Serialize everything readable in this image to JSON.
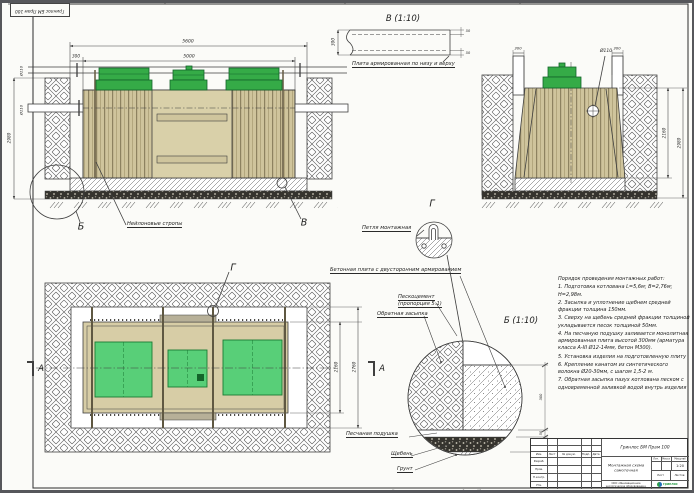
{
  "sheet": {
    "corner_stamp": "Гринлос БМ Прам 100",
    "footer_copied": "Копировал",
    "footer_format": "Формат A3"
  },
  "front_view": {
    "dim_overall": "5600",
    "dim_tank": "5000",
    "dim_offset": "300",
    "dim_depth": "2980",
    "dim_pipe_upper": "Ø110",
    "dim_pipe_lower": "Ø110",
    "label_slings": "Нейлоновые стропы",
    "callout_b": "Б",
    "callout_v": "В"
  },
  "detail_v": {
    "title": "В (1:10)",
    "label_plate": "Плита армированная по низу и верху",
    "dim_thickness": "300",
    "dim_cover_top": "50",
    "dim_cover_bottom": "50"
  },
  "side_view": {
    "dim_gap_left": "300",
    "dim_gap_right": "300",
    "dim_pipe": "Ø110",
    "dim_tank_height": "2160",
    "dim_pit_depth": "2980"
  },
  "detail_g": {
    "title": "Г",
    "label_loop": "Петля монтажная"
  },
  "plan_view": {
    "label_plate": "Бетонная плита с двусторонним армированием",
    "label_sandcement_1": "Пескоцемент",
    "label_sandcement_2": "(пропорция 5:1)",
    "label_backfill": "Обратная засыпка",
    "callout_g": "Г",
    "section_left": "А",
    "section_right": "А",
    "dim_tank_width": "2160",
    "dim_pit_width": "2760"
  },
  "detail_b": {
    "title": "Б (1:10)",
    "dim_plate": "300",
    "dim_sand": "50",
    "dim_gravel": "150",
    "label_sand": "Песчаная подушка",
    "label_gravel": "Щебень",
    "label_soil": "Грунт"
  },
  "notes": {
    "title": "Порядок проведения монтажных работ:",
    "items": [
      "1. Подготовка котлована L=5,6м; B=2,76м; H=2,98м.",
      "2. Засыпка и уплотнение щебнем средней фракции толщина 150мм.",
      "3. Сверху на щебень средней фракции толщиной укладывается песок толщиной 50мм.",
      "4. На песчаную подушку заливается монолитная армированная плита высотой 300мм (арматура класса А-III Ø12-14мм, бетон М300).",
      "5. Установка изделия на подготовленную плиту",
      "6. Крепление канатом из синтетического волокна Ø20-30мм, с шагом 1,5-2 м.",
      "7. Обратная засыпка пазух котлована песком с одновременной заливкой водой внутрь изделия"
    ]
  },
  "title_block": {
    "product": "Гринлос БМ Прам 100",
    "doc_title": "Монтажная схема самотечная",
    "company": "ООО «Инновационное экологическое оборудование»",
    "scale": "1:20",
    "logo_text": "гринлос",
    "col_izm": "Изм.",
    "col_list": "Лист",
    "col_doc": "№ докум.",
    "col_podp": "Подп.",
    "col_data": "Дата",
    "row_razrab": "Разраб.",
    "row_prov": "Пров.",
    "row_nkontr": "Н.контр.",
    "row_utv": "Утв.",
    "lit": "Лит.",
    "massa": "Масса",
    "masshtab": "Масштаб",
    "sheet_lbl": "Лист",
    "sheets_lbl": "Листов"
  },
  "colors": {
    "lid_green": "#35ab47",
    "plan_lid_green": "#58cf78",
    "tank_tan": "#cfc49c",
    "line": "#3f3f3f",
    "logo_green": "#2d9e4b",
    "logo_blue": "#1d6fb8"
  }
}
